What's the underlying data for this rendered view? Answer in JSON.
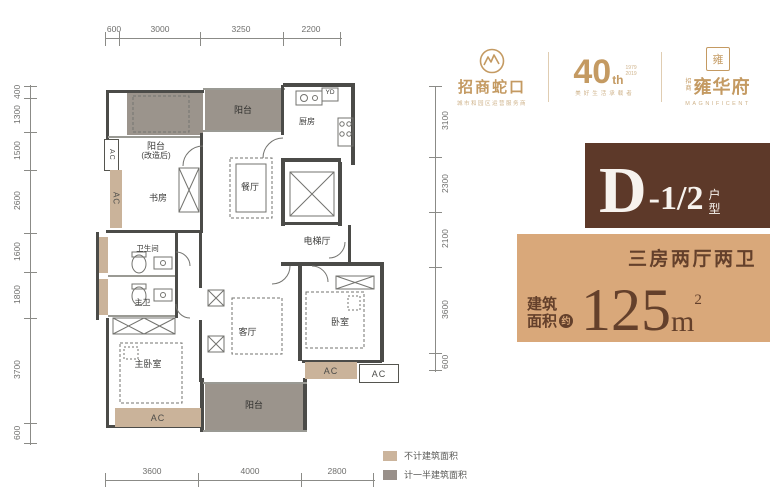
{
  "brand": {
    "shekou": {
      "name": "招商蛇口",
      "tagline": "城市和园区运营服务商"
    },
    "anniversary": {
      "number": "40",
      "suffix": "th",
      "year_start": "1979",
      "year_end": "2019",
      "tagline": "美好生活承载者"
    },
    "yonghuafu": {
      "seal_char": "雍",
      "prefix_top": "招",
      "prefix_bottom": "商",
      "name": "雍华府",
      "tagline": "MAGNIFICENT"
    }
  },
  "unit_info": {
    "letter": "D",
    "variant": "-1/2",
    "type_char_1": "户",
    "type_char_2": "型",
    "layout_desc": "三房两厅两卫",
    "area_label_line1": "建筑",
    "area_label_line2": "面积",
    "approx_char": "约",
    "area_value": "125",
    "area_unit": "m",
    "area_exponent": "2"
  },
  "legend": {
    "item1": {
      "label": "不计建筑面积",
      "color": "#cbb49c"
    },
    "item2": {
      "label": "计一半建筑面积",
      "color": "#99908a"
    }
  },
  "dimensions": {
    "top": [
      "600",
      "3000",
      "3250",
      "2200"
    ],
    "bottom": [
      "3600",
      "4000",
      "2800"
    ],
    "left": [
      "400",
      "1300",
      "1500",
      "2600",
      "1600",
      "1800",
      "3700",
      "600"
    ],
    "right": [
      "3100",
      "2300",
      "2100",
      "3600",
      "600"
    ]
  },
  "rooms": {
    "balcony": "阳台",
    "balcony_renovated_line1": "阳台",
    "balcony_renovated_line2": "(改造后)",
    "study": "书房",
    "kitchen": "厨房",
    "laundry_duct": "YD",
    "dining_room": "餐厅",
    "elevator_hall": "电梯厅",
    "bathroom": "卫生间",
    "master_bathroom": "主卫",
    "master_bedroom": "主卧室",
    "living_room": "客厅",
    "bedroom": "卧室",
    "ac_platform": "AC"
  },
  "colors": {
    "wall": "#4b4b48",
    "balcony_fill": "#9b948c",
    "ac_fill": "#cab39a",
    "brand_gold": "#c49a62",
    "unit_box_bg": "#5d3929",
    "area_box_bg": "#d9a87a",
    "area_text": "#64402b"
  }
}
